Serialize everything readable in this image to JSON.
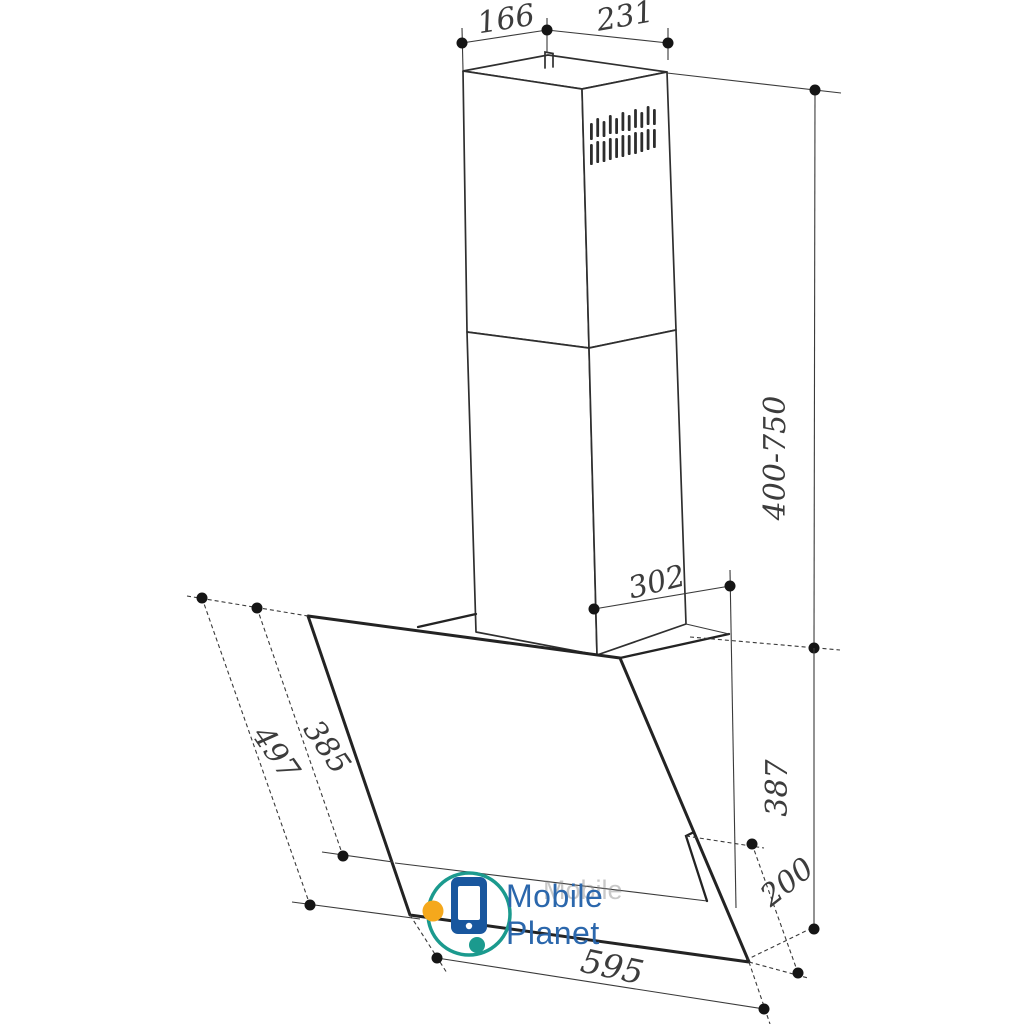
{
  "drawing": {
    "type": "technical-dimension-diagram",
    "subject": "wall-mounted inclined kitchen cooker hood with telescopic chimney",
    "line_color": "#2f2f2f",
    "background": "#ffffff",
    "dimensions": {
      "chimney_depth": "166",
      "chimney_width": "231",
      "chimney_height_range": "400-750",
      "top_depth": "302",
      "body_height": "387",
      "lower_section_length": "200",
      "panel_upper_length": "385",
      "panel_full_length": "497",
      "hood_width": "595"
    }
  },
  "watermark": {
    "line1": "Mobile",
    "line2": "Planet",
    "ghost": "Mobile",
    "text_color": "#2b67ac",
    "ghost_color": "#8a8a8a",
    "phone_color": "#19579e",
    "screen_color": "#ffffff",
    "ring_color": "#1b9a8e",
    "dot_orange": "#f5a81c",
    "dot_teal": "#1b9a8e"
  }
}
